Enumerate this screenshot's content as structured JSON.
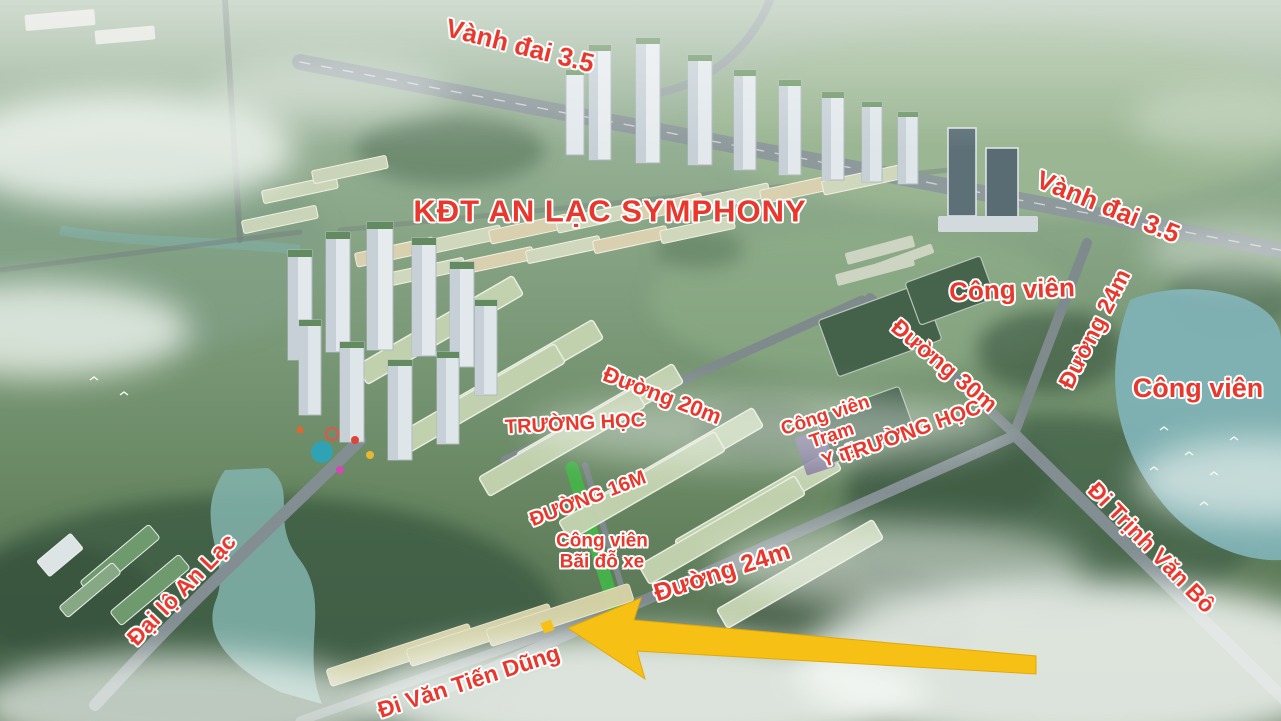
{
  "canvas": {
    "width": 1281,
    "height": 721
  },
  "title": "KĐT AN LẠC SYMPHONY",
  "colors": {
    "label_text": "#ea372c",
    "label_outline": "#ffffff",
    "arrow": "#f6c114",
    "water": "#7fb2b5",
    "park_highlight": "#44b648"
  },
  "labels": [
    {
      "id": "ring-road-35-top",
      "text": "Vành đai 3.5"
    },
    {
      "id": "project-title",
      "text": "KĐT AN LẠC SYMPHONY"
    },
    {
      "id": "ring-road-35-right",
      "text": "Vành đai 3.5"
    },
    {
      "id": "park-upper-right",
      "text": "Công viên"
    },
    {
      "id": "road-24m-right",
      "text": "Đường 24m"
    },
    {
      "id": "park-far-right",
      "text": "Công viên"
    },
    {
      "id": "road-30m",
      "text": "Đường 30m"
    },
    {
      "id": "road-20m",
      "text": "Đường 20m"
    },
    {
      "id": "school-left",
      "text": "TRƯỜNG HỌC"
    },
    {
      "id": "park-clinic-line1",
      "text": "Công viên"
    },
    {
      "id": "park-clinic-line2",
      "text": "Trạm"
    },
    {
      "id": "park-clinic-line3",
      "text": "Y tế"
    },
    {
      "id": "school-right",
      "text": "TRƯỜNG HỌC"
    },
    {
      "id": "road-16m",
      "text": "ĐƯỜNG 16M"
    },
    {
      "id": "park-parking-line1",
      "text": "Công viên"
    },
    {
      "id": "park-parking-line2",
      "text": "Bãi đỗ xe"
    },
    {
      "id": "road-24m-bottom",
      "text": "Đường 24m"
    },
    {
      "id": "road-trinh-van-bo",
      "text": "Đi Trịnh Văn Bô"
    },
    {
      "id": "avenue-an-lac",
      "text": "Đại lộ An Lạc"
    },
    {
      "id": "road-van-tien-dung",
      "text": "Đi Văn Tiến Dũng"
    }
  ],
  "annotations": {
    "arrow": {
      "shape": "arrow",
      "color": "#f6c114",
      "points": "left"
    },
    "lot_marker": {
      "shape": "square",
      "color": "#f6c114"
    }
  }
}
